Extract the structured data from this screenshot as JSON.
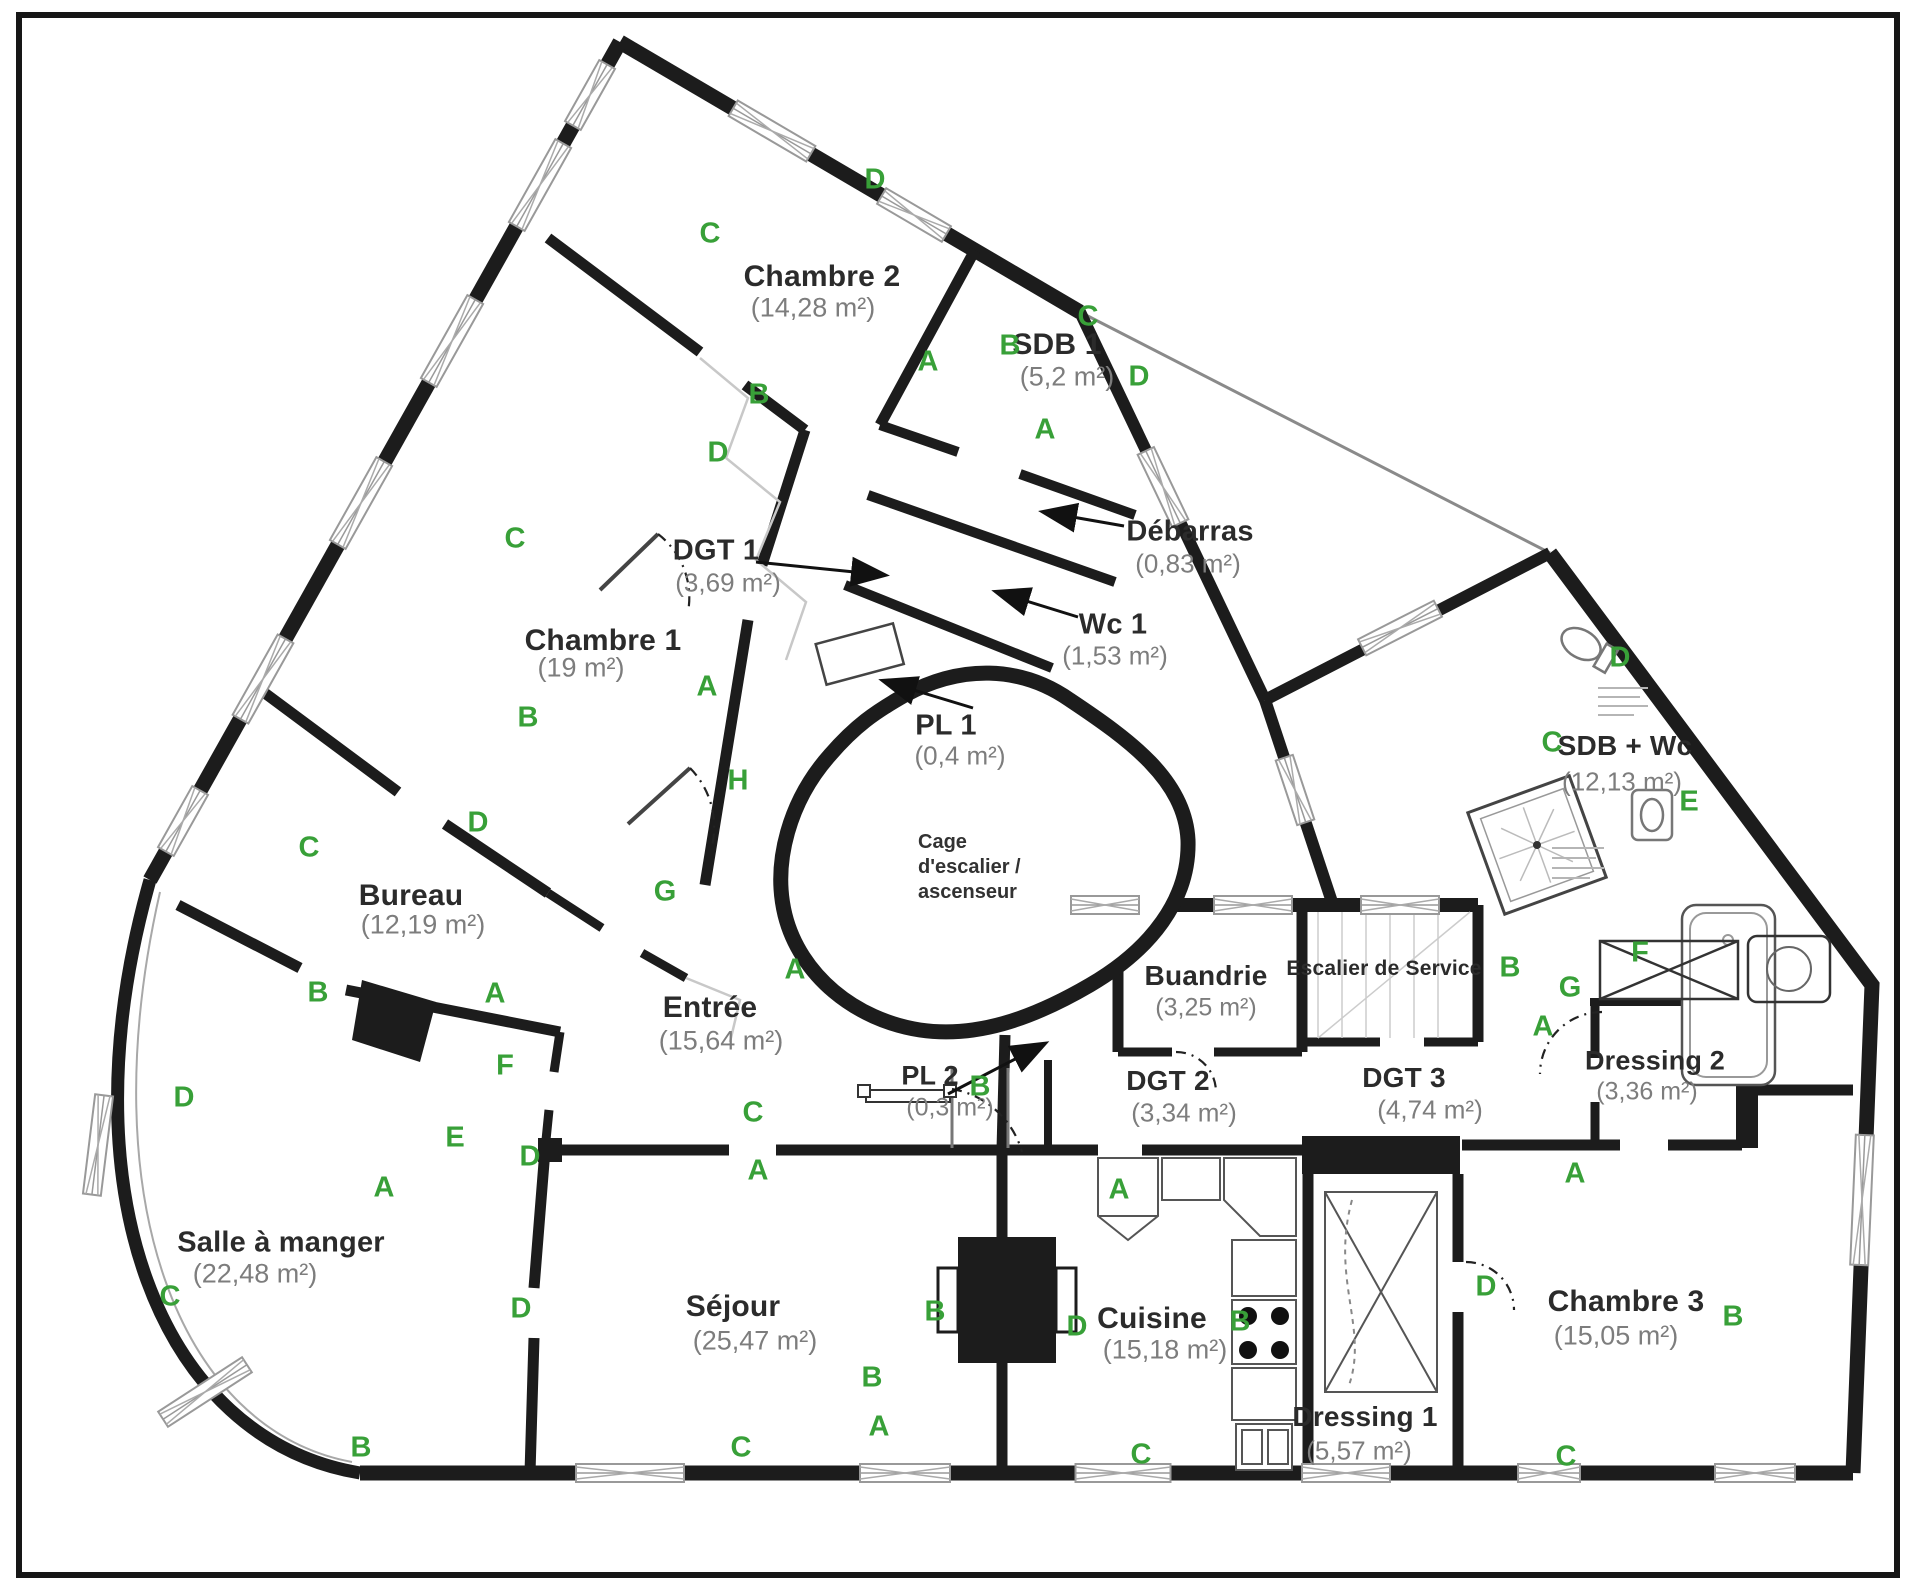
{
  "plan": {
    "colors": {
      "wall": "#1c1c1c",
      "thin_boundary": "#8a8a8a",
      "letter_green": "#38a038",
      "room_name": "#2b2b2b",
      "room_area": "#7d7d7d"
    },
    "core_label": {
      "lines": [
        "Cage",
        "d'escalier /",
        "ascenseur"
      ],
      "x": 918,
      "y": 830
    },
    "rooms": [
      {
        "id": "chambre-2",
        "name": "Chambre 2",
        "area": "(14,28 m²)",
        "nx": 822,
        "ny": 277,
        "ax": 813,
        "ay": 308
      },
      {
        "id": "sdb-1",
        "name": "SDB 1",
        "area": "(5,2 m²)",
        "nx": 1057,
        "ny": 345,
        "ax": 1067,
        "ay": 377
      },
      {
        "id": "debarras",
        "name": "Débarras",
        "area": "(0,83 m²)",
        "nx": 1190,
        "ny": 532,
        "ax": 1188,
        "ay": 564
      },
      {
        "id": "wc-1",
        "name": "Wc 1",
        "area": "(1,53 m²)",
        "nx": 1113,
        "ny": 625,
        "ax": 1115,
        "ay": 656
      },
      {
        "id": "dgt-1",
        "name": "DGT 1",
        "area": "(3,69 m²)",
        "nx": 716,
        "ny": 551,
        "ax": 728,
        "ay": 583
      },
      {
        "id": "pl-1",
        "name": "PL 1",
        "area": "(0,4 m²)",
        "nx": 946,
        "ny": 726,
        "ax": 960,
        "ay": 756
      },
      {
        "id": "chambre-1",
        "name": "Chambre 1",
        "area": "(19 m²)",
        "nx": 603,
        "ny": 641,
        "ax": 581,
        "ay": 668
      },
      {
        "id": "bureau",
        "name": "Bureau",
        "area": "(12,19 m²)",
        "nx": 411,
        "ny": 896,
        "ax": 423,
        "ay": 925
      },
      {
        "id": "buandrie",
        "name": "Buandrie",
        "area": "(3,25 m²)",
        "nx": 1206,
        "ny": 976,
        "ax": 1206,
        "ay": 1008
      },
      {
        "id": "escalier-service",
        "name": "Escalier de Service",
        "area": "",
        "nx": 1384,
        "ny": 969,
        "ax": 0,
        "ay": 0
      },
      {
        "id": "sdb-wc",
        "name": "SDB + Wc",
        "area": "(12,13 m²)",
        "nx": 1625,
        "ny": 746,
        "ax": 1622,
        "ay": 782
      },
      {
        "id": "dressing-2",
        "name": "Dressing 2",
        "area": "(3,36 m²)",
        "nx": 1655,
        "ny": 1061,
        "ax": 1647,
        "ay": 1092
      },
      {
        "id": "entree",
        "name": "Entrée",
        "area": "(15,64 m²)",
        "nx": 710,
        "ny": 1008,
        "ax": 721,
        "ay": 1041
      },
      {
        "id": "salle-a-manger",
        "name": "Salle à manger",
        "area": "(22,48 m²)",
        "nx": 281,
        "ny": 1243,
        "ax": 255,
        "ay": 1274
      },
      {
        "id": "sejour",
        "name": "Séjour",
        "area": "(25,47 m²)",
        "nx": 733,
        "ny": 1307,
        "ax": 755,
        "ay": 1341
      },
      {
        "id": "pl-2",
        "name": "PL 2",
        "area": "(0,3 m²)",
        "nx": 930,
        "ny": 1076,
        "ax": 950,
        "ay": 1108
      },
      {
        "id": "dgt-2",
        "name": "DGT 2",
        "area": "(3,34 m²)",
        "nx": 1168,
        "ny": 1081,
        "ax": 1184,
        "ay": 1113
      },
      {
        "id": "dgt-3",
        "name": "DGT 3",
        "area": "(4,74 m²)",
        "nx": 1404,
        "ny": 1078,
        "ax": 1430,
        "ay": 1110
      },
      {
        "id": "cuisine",
        "name": "Cuisine",
        "area": "(15,18 m²)",
        "nx": 1152,
        "ny": 1319,
        "ax": 1165,
        "ay": 1350
      },
      {
        "id": "dressing-1",
        "name": "Dressing 1",
        "area": "(5,57 m²)",
        "nx": 1365,
        "ny": 1417,
        "ax": 1359,
        "ay": 1451
      },
      {
        "id": "chambre-3",
        "name": "Chambre 3",
        "area": "(15,05 m²)",
        "nx": 1626,
        "ny": 1302,
        "ax": 1616,
        "ay": 1336
      }
    ],
    "letters": [
      {
        "ch": "D",
        "x": 875,
        "y": 180
      },
      {
        "ch": "C",
        "x": 710,
        "y": 234
      },
      {
        "ch": "A",
        "x": 928,
        "y": 362
      },
      {
        "ch": "B",
        "x": 759,
        "y": 395
      },
      {
        "ch": "C",
        "x": 1088,
        "y": 317
      },
      {
        "ch": "B",
        "x": 1010,
        "y": 346
      },
      {
        "ch": "D",
        "x": 1139,
        "y": 377
      },
      {
        "ch": "A",
        "x": 1045,
        "y": 430
      },
      {
        "ch": "D",
        "x": 718,
        "y": 453
      },
      {
        "ch": "C",
        "x": 515,
        "y": 539
      },
      {
        "ch": "A",
        "x": 707,
        "y": 687
      },
      {
        "ch": "B",
        "x": 528,
        "y": 718
      },
      {
        "ch": "H",
        "x": 738,
        "y": 781
      },
      {
        "ch": "D",
        "x": 478,
        "y": 823
      },
      {
        "ch": "C",
        "x": 309,
        "y": 848
      },
      {
        "ch": "G",
        "x": 665,
        "y": 892
      },
      {
        "ch": "A",
        "x": 795,
        "y": 970
      },
      {
        "ch": "B",
        "x": 318,
        "y": 993
      },
      {
        "ch": "A",
        "x": 495,
        "y": 994
      },
      {
        "ch": "F",
        "x": 505,
        "y": 1066
      },
      {
        "ch": "E",
        "x": 455,
        "y": 1138
      },
      {
        "ch": "D",
        "x": 530,
        "y": 1157
      },
      {
        "ch": "A",
        "x": 384,
        "y": 1188
      },
      {
        "ch": "D",
        "x": 184,
        "y": 1098
      },
      {
        "ch": "C",
        "x": 170,
        "y": 1297
      },
      {
        "ch": "B",
        "x": 361,
        "y": 1448
      },
      {
        "ch": "D",
        "x": 521,
        "y": 1309
      },
      {
        "ch": "C",
        "x": 741,
        "y": 1448
      },
      {
        "ch": "B",
        "x": 872,
        "y": 1378
      },
      {
        "ch": "A",
        "x": 879,
        "y": 1427
      },
      {
        "ch": "B",
        "x": 935,
        "y": 1312
      },
      {
        "ch": "C",
        "x": 753,
        "y": 1113
      },
      {
        "ch": "A",
        "x": 758,
        "y": 1171
      },
      {
        "ch": "B",
        "x": 980,
        "y": 1087
      },
      {
        "ch": "A",
        "x": 1119,
        "y": 1190
      },
      {
        "ch": "D",
        "x": 1077,
        "y": 1327
      },
      {
        "ch": "B",
        "x": 1240,
        "y": 1322
      },
      {
        "ch": "C",
        "x": 1141,
        "y": 1455
      },
      {
        "ch": "B",
        "x": 1510,
        "y": 968
      },
      {
        "ch": "G",
        "x": 1570,
        "y": 988
      },
      {
        "ch": "A",
        "x": 1543,
        "y": 1027
      },
      {
        "ch": "F",
        "x": 1640,
        "y": 953
      },
      {
        "ch": "C",
        "x": 1552,
        "y": 743
      },
      {
        "ch": "D",
        "x": 1620,
        "y": 658
      },
      {
        "ch": "E",
        "x": 1689,
        "y": 802
      },
      {
        "ch": "A",
        "x": 1575,
        "y": 1174
      },
      {
        "ch": "D",
        "x": 1486,
        "y": 1287
      },
      {
        "ch": "B",
        "x": 1733,
        "y": 1317
      },
      {
        "ch": "C",
        "x": 1566,
        "y": 1457
      }
    ]
  }
}
